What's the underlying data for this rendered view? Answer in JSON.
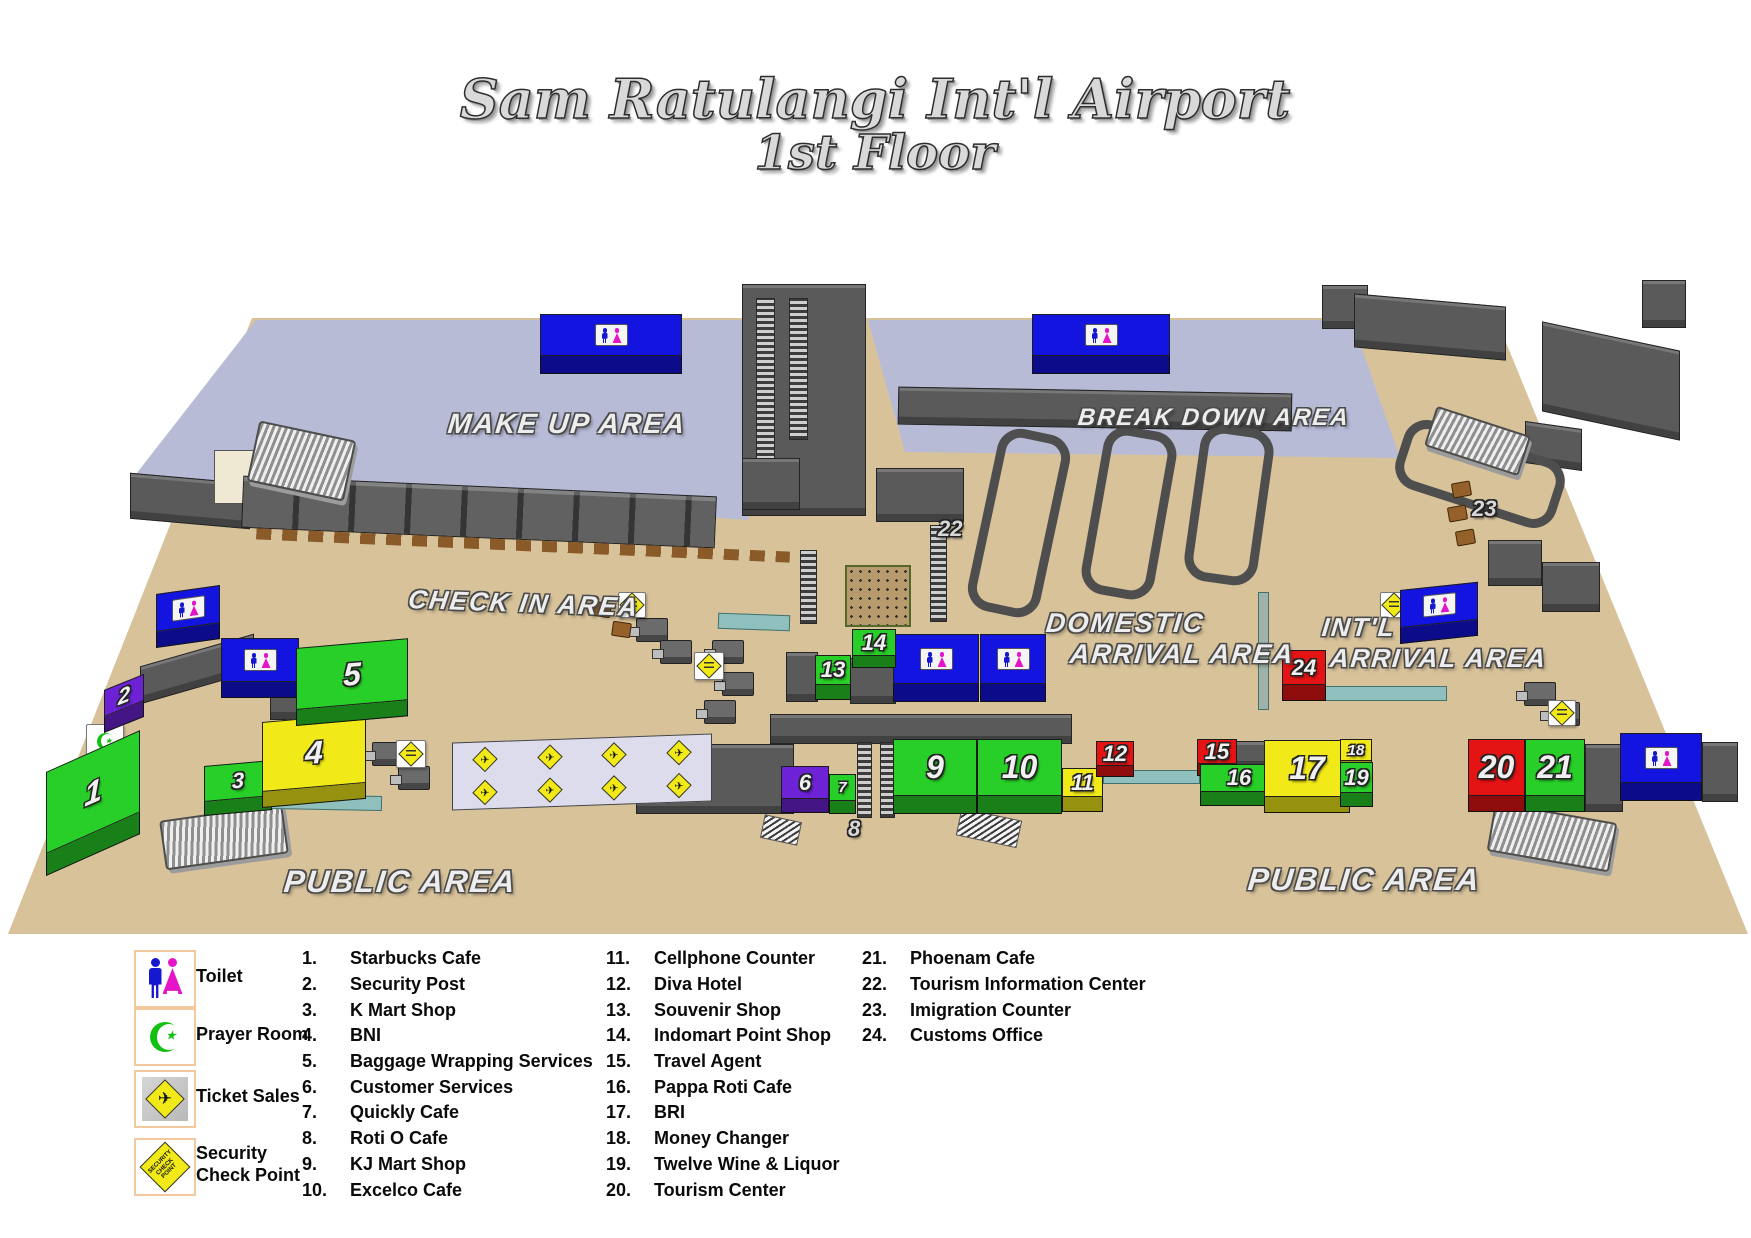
{
  "title": {
    "line1": "Sam Ratulangi Int'l Airport",
    "line2": "1st Floor"
  },
  "map": {
    "area_labels": {
      "make_up": "MAKE UP AREA",
      "break_down": "BREAK DOWN AREA",
      "check_in": "CHECK IN AREA",
      "domestic_line1": "DOMESTIC",
      "domestic_line2": "ARRIVAL AREA",
      "intl_line1": "INT'L",
      "intl_line2": "ARRIVAL AREA",
      "public_left": "PUBLIC AREA",
      "public_right": "PUBLIC AREA"
    },
    "markers": [
      {
        "num": "1",
        "color": "green"
      },
      {
        "num": "2",
        "color": "purple"
      },
      {
        "num": "3",
        "color": "green"
      },
      {
        "num": "4",
        "color": "yellow"
      },
      {
        "num": "5",
        "color": "green"
      },
      {
        "num": "6",
        "color": "purple"
      },
      {
        "num": "7",
        "color": "green"
      },
      {
        "num": "8",
        "color": "none"
      },
      {
        "num": "9",
        "color": "green"
      },
      {
        "num": "10",
        "color": "green"
      },
      {
        "num": "11",
        "color": "yellow"
      },
      {
        "num": "12",
        "color": "red"
      },
      {
        "num": "13",
        "color": "green"
      },
      {
        "num": "14",
        "color": "green"
      },
      {
        "num": "15",
        "color": "red"
      },
      {
        "num": "16",
        "color": "green"
      },
      {
        "num": "17",
        "color": "yellow"
      },
      {
        "num": "18",
        "color": "yellow"
      },
      {
        "num": "19",
        "color": "green"
      },
      {
        "num": "20",
        "color": "red"
      },
      {
        "num": "21",
        "color": "green"
      },
      {
        "num": "22",
        "color": "none"
      },
      {
        "num": "23",
        "color": "none"
      },
      {
        "num": "24",
        "color": "red"
      }
    ]
  },
  "icons": {
    "plane_glyph": "✈",
    "star_glyph": "★",
    "toilet": "toilet-sign",
    "prayer": "crescent-star",
    "ticket": "airplane-diamond",
    "security": "security-diamond"
  },
  "palette": {
    "floor_tan": "#d7c29a",
    "area_lavender": "#b7bbd6",
    "unit_green": "#28cf28",
    "unit_yellow": "#f2ea18",
    "unit_red": "#e51414",
    "unit_purple": "#6d22d6",
    "toilet_blue": "#1414e0",
    "walkway_teal": "#8fc0bd",
    "structure_gray": "#5a5a5a"
  },
  "legend": {
    "icons": [
      {
        "label": "Toilet"
      },
      {
        "label": "Prayer Room"
      },
      {
        "label": "Ticket Sales"
      },
      {
        "label": "Security Check Point"
      }
    ],
    "security_icon_text": "SECURITY CHECK POINT",
    "col1": [
      {
        "num": "1.",
        "name": "Starbucks Cafe"
      },
      {
        "num": "2.",
        "name": "Security Post"
      },
      {
        "num": "3.",
        "name": "K Mart Shop"
      },
      {
        "num": "4.",
        "name": "BNI"
      },
      {
        "num": "5.",
        "name": "Baggage Wrapping Services"
      },
      {
        "num": "6.",
        "name": "Customer Services"
      },
      {
        "num": "7.",
        "name": "Quickly Cafe"
      },
      {
        "num": "8.",
        "name": "Roti O Cafe"
      },
      {
        "num": "9.",
        "name": "KJ Mart Shop"
      },
      {
        "num": "10.",
        "name": "Excelco Cafe"
      }
    ],
    "col2": [
      {
        "num": "11.",
        "name": "Cellphone Counter"
      },
      {
        "num": "12.",
        "name": "Diva Hotel"
      },
      {
        "num": "13.",
        "name": "Souvenir Shop"
      },
      {
        "num": "14.",
        "name": "Indomart Point Shop"
      },
      {
        "num": "15.",
        "name": "Travel Agent"
      },
      {
        "num": "16.",
        "name": "Pappa Roti Cafe"
      },
      {
        "num": "17.",
        "name": "BRI"
      },
      {
        "num": "18.",
        "name": "Money Changer"
      },
      {
        "num": "19.",
        "name": "Twelve Wine & Liquor"
      },
      {
        "num": "20.",
        "name": "Tourism Center"
      }
    ],
    "col3": [
      {
        "num": "21.",
        "name": "Phoenam Cafe"
      },
      {
        "num": "22.",
        "name": "Tourism Information Center"
      },
      {
        "num": "23.",
        "name": "Imigration Counter"
      },
      {
        "num": "24.",
        "name": "Customs Office"
      }
    ]
  }
}
